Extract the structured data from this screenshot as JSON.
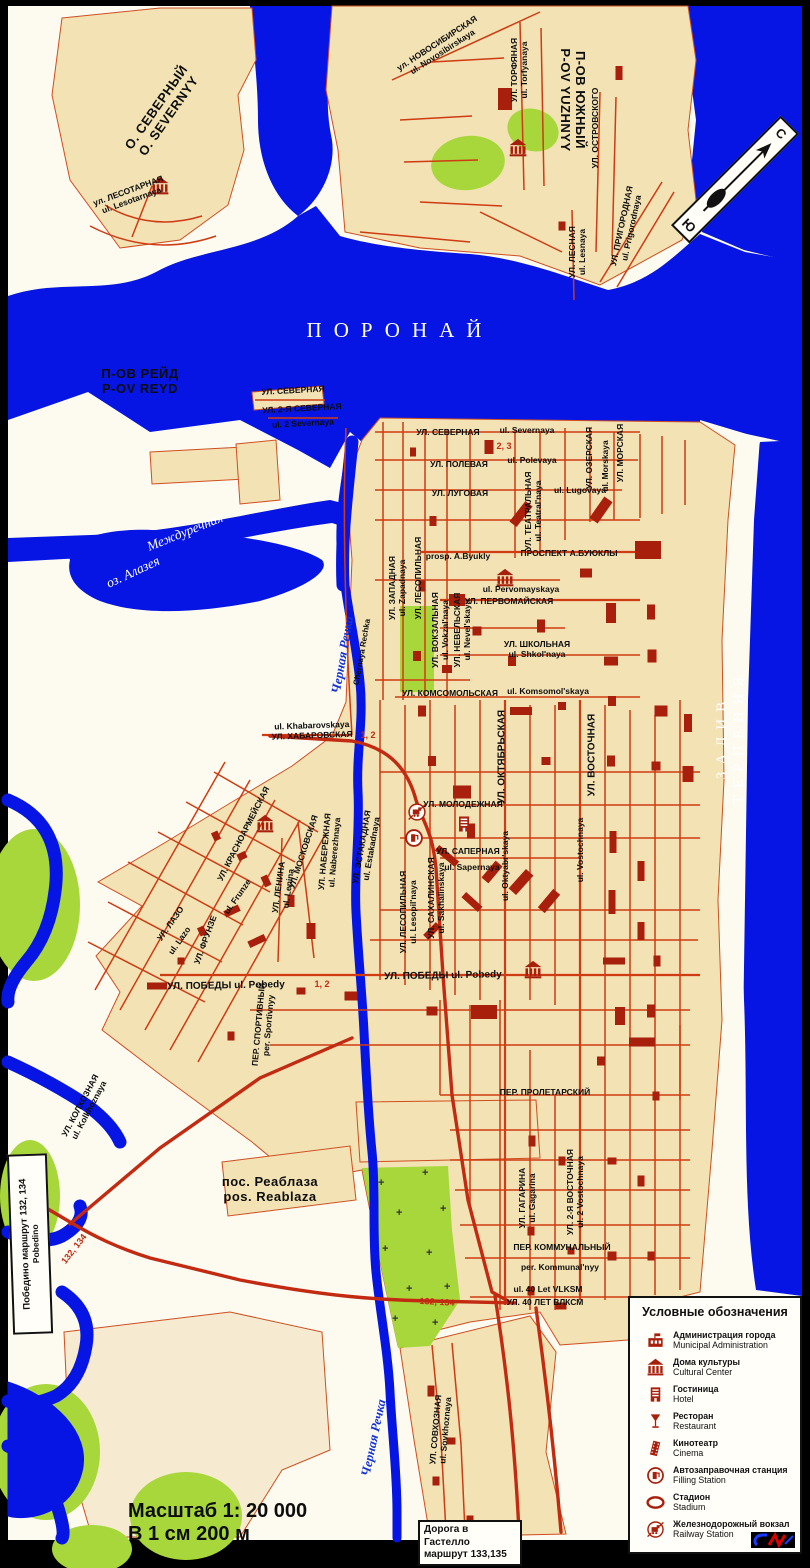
{
  "colors": {
    "water": "#0615e4",
    "land_block": "#f2e2b4",
    "land_bg": "#fdfbf0",
    "street": "#cf3b12",
    "building": "#a81f0c",
    "park": "#a8d73c",
    "route": "#c22a12",
    "frame": "#000000",
    "sea_label": "#ffffff"
  },
  "compass": {
    "north": "С",
    "south": "Ю"
  },
  "scale": {
    "line1": "Масштаб 1: 20 000",
    "line2": "В 1 см 200 м"
  },
  "boxes": {
    "gastello": {
      "line1": "Дорога в Гастелло",
      "line2": "маршрут 133,135"
    },
    "pobedino": {
      "line1": "Победино маршрут 132, 134",
      "line2": "Pobedino"
    }
  },
  "legend": {
    "title": "Условные обозначения",
    "items": [
      {
        "icon": "admin",
        "ru": "Администрация города",
        "en": "Municipal Administration"
      },
      {
        "icon": "culture",
        "ru": "Дома культуры",
        "en": "Cultural Center"
      },
      {
        "icon": "hotel",
        "ru": "Гостиница",
        "en": "Hotel"
      },
      {
        "icon": "restaurant",
        "ru": "Ресторан",
        "en": "Restaurant"
      },
      {
        "icon": "cinema",
        "ru": "Кинотеатр",
        "en": "Cinema"
      },
      {
        "icon": "fuel",
        "ru": "Автозаправочная станция",
        "en": "Filling Station"
      },
      {
        "icon": "stadium",
        "ru": "Стадион",
        "en": "Stadium"
      },
      {
        "icon": "railway",
        "ru": "Железнодорожный вокзал",
        "en": "Railway Station"
      }
    ]
  },
  "map_labels": [
    {
      "t": "О. СЕВЕРНЫЙ\nO. SEVERNYY",
      "x": 163,
      "y": 112,
      "r": -55,
      "c": "geo"
    },
    {
      "t": "П-ОВ ЮЖНЫЙ\nP-OV YUZHNYY",
      "x": 572,
      "y": 100,
      "r": 90,
      "c": "geo"
    },
    {
      "t": "П-ОВ РЕЙД\nP-OV REYD",
      "x": 140,
      "y": 382,
      "r": 0,
      "c": "geo"
    },
    {
      "t": "ПОРОНАЙ",
      "x": 400,
      "y": 330,
      "r": 0,
      "c": "sea"
    },
    {
      "t": "ЗАЛИВ  ТЕРПЕНИЯ",
      "x": 731,
      "y": 737,
      "r": -90,
      "c": "sea2"
    },
    {
      "t": "Междуречная",
      "x": 185,
      "y": 532,
      "r": -22,
      "c": "riv"
    },
    {
      "t": "оз. Алазея",
      "x": 133,
      "y": 572,
      "r": -25,
      "c": "riv"
    },
    {
      "t": "Черная Речка",
      "x": 343,
      "y": 655,
      "r": -80,
      "c": "rivname"
    },
    {
      "t": "Chernaya Rechka",
      "x": 362,
      "y": 652,
      "r": -80,
      "c": "stlat"
    },
    {
      "t": "Черная Речка",
      "x": 374,
      "y": 1438,
      "r": -78,
      "c": "rivname"
    },
    {
      "t": "пос. Реаблаза\npos. Reablaza",
      "x": 270,
      "y": 1190,
      "r": 0,
      "c": "geo"
    },
    {
      "t": "ул. ЛЕСОТАРНАЯ\nul. Lesotarnaya",
      "x": 130,
      "y": 196,
      "r": -20,
      "c": "st"
    },
    {
      "t": "ул. НОВОСИБИРСКАЯ\nul. Novosibirskaya",
      "x": 440,
      "y": 48,
      "r": -33,
      "c": "st"
    },
    {
      "t": "УЛ. ТОРФЯНАЯ\nul. Torfyanaya",
      "x": 520,
      "y": 70,
      "r": -90,
      "c": "st"
    },
    {
      "t": "УЛ. ОСТРОВСКОГО",
      "x": 596,
      "y": 128,
      "r": -90,
      "c": "st"
    },
    {
      "t": "УЛ. ЛЕСНАЯ\nul. Lesnaya",
      "x": 578,
      "y": 252,
      "r": -90,
      "c": "st"
    },
    {
      "t": "УЛ. ПРИГОРОДНАЯ\nul. Prigorodnaya",
      "x": 627,
      "y": 227,
      "r": -78,
      "c": "st"
    },
    {
      "t": "УЛ. СЕВЕРНАЯ",
      "x": 293,
      "y": 391,
      "r": -3,
      "c": "st"
    },
    {
      "t": "УЛ. 2-Я СЕВЕРНАЯ",
      "x": 302,
      "y": 409,
      "r": -3,
      "c": "st"
    },
    {
      "t": "ul. 2 Severnaya",
      "x": 303,
      "y": 424,
      "r": -3,
      "c": "st"
    },
    {
      "t": "УЛ. СЕВЕРНАЯ",
      "x": 448,
      "y": 433,
      "r": 0,
      "c": "st"
    },
    {
      "t": "ul. Severnaya",
      "x": 527,
      "y": 431,
      "r": 0,
      "c": "st"
    },
    {
      "t": "УЛ. ПОЛЕВАЯ",
      "x": 459,
      "y": 465,
      "r": 0,
      "c": "st"
    },
    {
      "t": "ul. Polevaya",
      "x": 532,
      "y": 461,
      "r": 0,
      "c": "st"
    },
    {
      "t": "УЛ. ЛУГОВАЯ",
      "x": 460,
      "y": 494,
      "r": 0,
      "c": "st"
    },
    {
      "t": "ul. Lugovaya",
      "x": 580,
      "y": 491,
      "r": 0,
      "c": "st"
    },
    {
      "t": "УЛ. ТЕАТРАЛЬНАЯ\nul. Teatral'naya",
      "x": 534,
      "y": 511,
      "r": -90,
      "c": "st"
    },
    {
      "t": "УЛ. ОЗЕРСКАЯ",
      "x": 590,
      "y": 458,
      "r": -90,
      "c": "st"
    },
    {
      "t": "ul. Morskaya",
      "x": 606,
      "y": 466,
      "r": -90,
      "c": "st"
    },
    {
      "t": "УЛ. МОРСКАЯ",
      "x": 621,
      "y": 453,
      "r": -90,
      "c": "st"
    },
    {
      "t": "prosp. A.Byukly",
      "x": 458,
      "y": 557,
      "r": 0,
      "c": "st"
    },
    {
      "t": "ПРОСПЕКТ  А.БУЮКЛЫ",
      "x": 569,
      "y": 554,
      "r": 0,
      "c": "st"
    },
    {
      "t": "ul. Pervomayskaya",
      "x": 521,
      "y": 590,
      "r": 0,
      "c": "st"
    },
    {
      "t": "УЛ. ПЕРВОМАЙСКАЯ",
      "x": 509,
      "y": 602,
      "r": 0,
      "c": "st"
    },
    {
      "t": "УЛ. ШКОЛЬНАЯ\nul. Shkol'naya",
      "x": 537,
      "y": 650,
      "r": 0,
      "c": "st"
    },
    {
      "t": "УЛ. КОМСОМОЛЬСКАЯ",
      "x": 450,
      "y": 694,
      "r": 0,
      "c": "st"
    },
    {
      "t": "ul. Komsomol'skaya",
      "x": 548,
      "y": 692,
      "r": 0,
      "c": "st"
    },
    {
      "t": "УЛ. ЗАПАДНАЯ\nul. Zapadnaya",
      "x": 398,
      "y": 588,
      "r": -90,
      "c": "st"
    },
    {
      "t": "УЛ. ЛЕСОПИЛЬНАЯ",
      "x": 419,
      "y": 578,
      "r": -90,
      "c": "st"
    },
    {
      "t": "УЛ. ВОКЗАЛЬНАЯ\nul. Vokzal'naya",
      "x": 441,
      "y": 630,
      "r": -90,
      "c": "st"
    },
    {
      "t": "УЛ. НЕВЕЛЬСКАЯ\nul. Nevel'skaya",
      "x": 463,
      "y": 630,
      "r": -90,
      "c": "st"
    },
    {
      "t": "ul. Khabarovskaya\nУЛ. ХАБАРОВСКАЯ",
      "x": 312,
      "y": 731,
      "r": -2,
      "c": "st"
    },
    {
      "t": "УЛ. МОЛОДЕЖНАЯ",
      "x": 463,
      "y": 805,
      "r": 0,
      "c": "st"
    },
    {
      "t": "УЛ. ОКТЯБРЬСКАЯ",
      "x": 502,
      "y": 757,
      "r": -90,
      "c": "st2"
    },
    {
      "t": "ul. Oktyabr'skaya",
      "x": 506,
      "y": 866,
      "r": -90,
      "c": "st"
    },
    {
      "t": "УЛ. ВОСТОЧНАЯ",
      "x": 592,
      "y": 755,
      "r": -90,
      "c": "st2"
    },
    {
      "t": "ul. Vostochnaya",
      "x": 581,
      "y": 850,
      "r": -90,
      "c": "st"
    },
    {
      "t": "УЛ. САПЕРНАЯ",
      "x": 468,
      "y": 852,
      "r": 0,
      "c": "st"
    },
    {
      "t": "ul. Sapernaya",
      "x": 472,
      "y": 868,
      "r": 0,
      "c": "st"
    },
    {
      "t": "УЛ. САХАЛИНСКАЯ\nul. Sakhalinskaya",
      "x": 437,
      "y": 898,
      "r": -90,
      "c": "st"
    },
    {
      "t": "УЛ. ЛЕСОПИЛЬНАЯ\nul. Lesopil'naya",
      "x": 409,
      "y": 912,
      "r": -90,
      "c": "st"
    },
    {
      "t": "УЛ. НАБЕРЕЖНАЯ\nul. Naberezhnaya",
      "x": 330,
      "y": 852,
      "r": -85,
      "c": "st"
    },
    {
      "t": "УЛ. ЭСТАКАДНАЯ\nul. Estakadnaya",
      "x": 367,
      "y": 848,
      "r": -80,
      "c": "st"
    },
    {
      "t": "УЛ. КРАСНОАРМЕЙСКАЯ",
      "x": 244,
      "y": 834,
      "r": -63,
      "c": "st"
    },
    {
      "t": "УЛ. МОСКОВСКАЯ",
      "x": 304,
      "y": 852,
      "r": -72,
      "c": "st"
    },
    {
      "t": "УЛ. ЛЕНИНА\nul. Lenina",
      "x": 284,
      "y": 888,
      "r": -82,
      "c": "st"
    },
    {
      "t": "ul. Frunze",
      "x": 238,
      "y": 897,
      "r": -55,
      "c": "st"
    },
    {
      "t": "УЛ. ФРУНЗЕ",
      "x": 206,
      "y": 940,
      "r": -70,
      "c": "st"
    },
    {
      "t": "УЛ. ЛАЗО",
      "x": 171,
      "y": 924,
      "r": -55,
      "c": "st"
    },
    {
      "t": "ul. Lazo",
      "x": 180,
      "y": 941,
      "r": -55,
      "c": "st"
    },
    {
      "t": "УЛ. ПОБЕДЫ  ul. Pobedy",
      "x": 226,
      "y": 986,
      "r": -1,
      "c": "st2"
    },
    {
      "t": "УЛ. ПОБЕДЫ  ul. Pobedy",
      "x": 443,
      "y": 976,
      "r": -1,
      "c": "st2"
    },
    {
      "t": "ПЕР. СПОРТИВНЫЙ\nper. Sportivnyy",
      "x": 264,
      "y": 1025,
      "r": -85,
      "c": "st"
    },
    {
      "t": "ПЕР. ПРОЛЕТАРСКИЙ",
      "x": 545,
      "y": 1093,
      "r": 0,
      "c": "st"
    },
    {
      "t": "УЛ. КОЛХОЗНАЯ\nul. Kolkhoznaya",
      "x": 85,
      "y": 1108,
      "r": -62,
      "c": "st"
    },
    {
      "t": "УЛ. ГАГАРИНА\nul. Gagarina",
      "x": 528,
      "y": 1198,
      "r": -90,
      "c": "st"
    },
    {
      "t": "УЛ. 2-Я ВОСТОЧНАЯ\nul. 2 Vostochnaya",
      "x": 576,
      "y": 1192,
      "r": -90,
      "c": "st"
    },
    {
      "t": "ПЕР.  КОММУНАЛЬНЫЙ",
      "x": 562,
      "y": 1248,
      "r": 0,
      "c": "st"
    },
    {
      "t": "per.  Kommunal'nyy",
      "x": 560,
      "y": 1268,
      "r": 0,
      "c": "st"
    },
    {
      "t": "ul. 40 Let VLKSM",
      "x": 548,
      "y": 1290,
      "r": 0,
      "c": "st"
    },
    {
      "t": "УЛ. 40 ЛЕТ ВЛКСМ",
      "x": 545,
      "y": 1303,
      "r": 0,
      "c": "st"
    },
    {
      "t": "УЛ. СОВХОЗНАЯ\nul. Sovkhoznaya",
      "x": 441,
      "y": 1430,
      "r": -85,
      "c": "st"
    },
    {
      "t": "2, 3",
      "x": 504,
      "y": 446,
      "r": 0,
      "c": "rt"
    },
    {
      "t": "1, 2",
      "x": 368,
      "y": 735,
      "r": 0,
      "c": "rt"
    },
    {
      "t": "1, 2",
      "x": 322,
      "y": 984,
      "r": 0,
      "c": "rt"
    },
    {
      "t": "132, 134",
      "x": 74,
      "y": 1249,
      "r": -52,
      "c": "rt"
    },
    {
      "t": "132, 134",
      "x": 437,
      "y": 1302,
      "r": 3,
      "c": "rt"
    }
  ],
  "map_icons": [
    {
      "type": "culture",
      "x": 160,
      "y": 186
    },
    {
      "type": "culture",
      "x": 518,
      "y": 148
    },
    {
      "type": "culture",
      "x": 505,
      "y": 578
    },
    {
      "type": "culture",
      "x": 265,
      "y": 824
    },
    {
      "type": "culture",
      "x": 533,
      "y": 970
    },
    {
      "type": "hotel",
      "x": 464,
      "y": 824
    },
    {
      "type": "railway",
      "x": 417,
      "y": 812
    },
    {
      "type": "fuel",
      "x": 414,
      "y": 838
    }
  ],
  "buildings": [
    [
      505,
      99,
      14,
      22,
      0
    ],
    [
      562,
      226,
      7,
      9,
      0
    ],
    [
      619,
      73,
      7,
      14,
      0
    ],
    [
      413,
      452,
      6,
      9,
      0
    ],
    [
      489,
      447,
      9,
      14,
      0
    ],
    [
      433,
      521,
      7,
      10,
      0
    ],
    [
      521,
      514,
      9,
      26,
      38
    ],
    [
      601,
      510,
      10,
      26,
      35
    ],
    [
      648,
      550,
      26,
      18,
      0
    ],
    [
      586,
      573,
      12,
      9,
      0
    ],
    [
      422,
      586,
      7,
      11,
      0
    ],
    [
      457,
      600,
      16,
      12,
      0
    ],
    [
      477,
      631,
      9,
      9,
      0
    ],
    [
      541,
      626,
      8,
      13,
      0
    ],
    [
      611,
      613,
      10,
      20,
      0
    ],
    [
      651,
      612,
      8,
      15,
      0
    ],
    [
      417,
      656,
      8,
      10,
      0
    ],
    [
      447,
      669,
      10,
      8,
      0
    ],
    [
      512,
      661,
      8,
      10,
      0
    ],
    [
      611,
      661,
      14,
      9,
      0
    ],
    [
      652,
      656,
      9,
      13,
      0
    ],
    [
      422,
      711,
      8,
      11,
      0
    ],
    [
      521,
      711,
      22,
      8,
      0
    ],
    [
      562,
      706,
      8,
      8,
      0
    ],
    [
      612,
      701,
      8,
      10,
      0
    ],
    [
      661,
      711,
      13,
      11,
      0
    ],
    [
      688,
      723,
      8,
      18,
      0
    ],
    [
      462,
      792,
      18,
      13,
      0
    ],
    [
      432,
      761,
      8,
      10,
      0
    ],
    [
      546,
      761,
      9,
      8,
      0
    ],
    [
      611,
      761,
      8,
      11,
      0
    ],
    [
      656,
      766,
      9,
      9,
      0
    ],
    [
      688,
      774,
      11,
      16,
      0
    ],
    [
      471,
      831,
      8,
      15,
      0
    ],
    [
      447,
      856,
      26,
      7,
      40
    ],
    [
      492,
      872,
      9,
      22,
      40
    ],
    [
      521,
      882,
      10,
      26,
      42
    ],
    [
      549,
      901,
      9,
      24,
      40
    ],
    [
      472,
      902,
      22,
      7,
      42
    ],
    [
      432,
      931,
      7,
      18,
      45
    ],
    [
      613,
      842,
      7,
      22,
      0
    ],
    [
      641,
      871,
      7,
      20,
      0
    ],
    [
      612,
      902,
      7,
      24,
      0
    ],
    [
      641,
      931,
      7,
      18,
      0
    ],
    [
      614,
      961,
      22,
      7,
      0
    ],
    [
      657,
      961,
      7,
      11,
      0
    ],
    [
      620,
      1016,
      10,
      18,
      0
    ],
    [
      651,
      1011,
      8,
      13,
      0
    ],
    [
      484,
      1012,
      26,
      14,
      0
    ],
    [
      432,
      1011,
      11,
      9,
      0
    ],
    [
      642,
      1042,
      26,
      9,
      0
    ],
    [
      601,
      1061,
      8,
      9,
      0
    ],
    [
      656,
      1096,
      7,
      9,
      0
    ],
    [
      532,
      1141,
      7,
      11,
      0
    ],
    [
      562,
      1161,
      7,
      9,
      0
    ],
    [
      612,
      1161,
      9,
      7,
      0
    ],
    [
      641,
      1181,
      7,
      11,
      0
    ],
    [
      531,
      1231,
      7,
      9,
      0
    ],
    [
      571,
      1251,
      7,
      7,
      0
    ],
    [
      612,
      1256,
      9,
      9,
      0
    ],
    [
      651,
      1256,
      7,
      9,
      0
    ],
    [
      531,
      1291,
      7,
      9,
      0
    ],
    [
      561,
      1306,
      11,
      7,
      0
    ],
    [
      216,
      836,
      7,
      9,
      -25
    ],
    [
      242,
      856,
      9,
      7,
      -25
    ],
    [
      266,
      881,
      7,
      11,
      -25
    ],
    [
      232,
      911,
      16,
      7,
      -25
    ],
    [
      202,
      931,
      7,
      9,
      -25
    ],
    [
      291,
      901,
      7,
      12,
      0
    ],
    [
      257,
      941,
      18,
      7,
      -25
    ],
    [
      311,
      931,
      9,
      16,
      0
    ],
    [
      181,
      961,
      7,
      7,
      0
    ],
    [
      157,
      986,
      20,
      7,
      0
    ],
    [
      301,
      991,
      9,
      7,
      0
    ],
    [
      351,
      996,
      13,
      9,
      0
    ],
    [
      231,
      1036,
      7,
      9,
      0
    ],
    [
      431,
      1391,
      7,
      11,
      0
    ],
    [
      451,
      1441,
      9,
      7,
      0
    ],
    [
      436,
      1481,
      7,
      9,
      0
    ],
    [
      470,
      1519,
      7,
      7,
      0
    ]
  ],
  "cemetery_marks": [
    [
      378,
      1186
    ],
    [
      422,
      1176
    ],
    [
      396,
      1216
    ],
    [
      440,
      1212
    ],
    [
      382,
      1252
    ],
    [
      426,
      1256
    ],
    [
      406,
      1292
    ],
    [
      444,
      1290
    ],
    [
      392,
      1322
    ],
    [
      432,
      1326
    ]
  ]
}
